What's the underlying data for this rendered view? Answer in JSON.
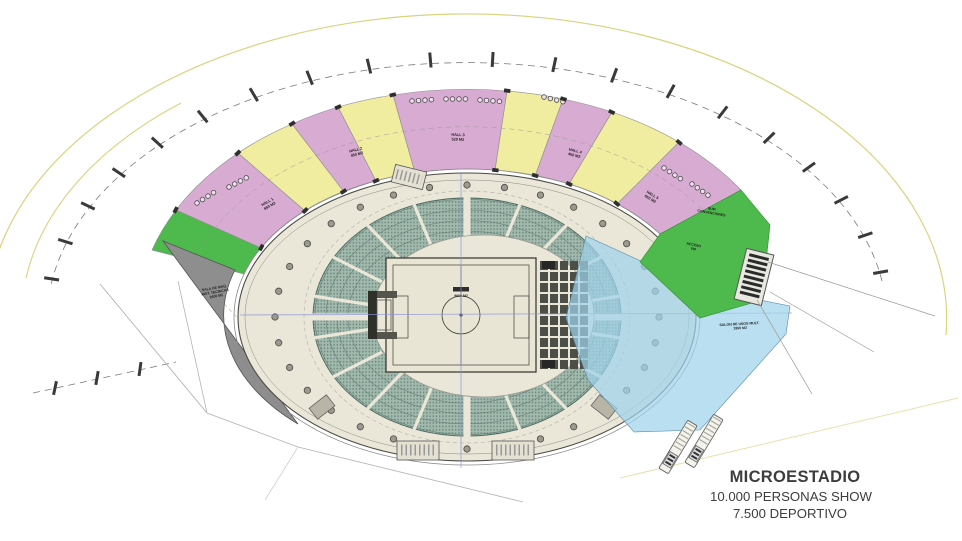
{
  "title_block": {
    "title": "MICROESTADIO",
    "line2": "10.000 PERSONAS SHOW",
    "line3": "7.500 DEPORTIVO"
  },
  "zones": {
    "hall_1": {
      "name": "HALL 1",
      "area": "650 M2"
    },
    "hall_2": {
      "name": "HALL 2",
      "area": "450 M2"
    },
    "hall_3": {
      "name": "HALL 3",
      "area": "520 M2"
    },
    "hall_4": {
      "name": "HALL 4",
      "area": "450 M2"
    },
    "hall_5": {
      "name": "HALL 5",
      "area": "650 M2"
    },
    "machine_room": {
      "line1": "SALA DE MAQ.",
      "line2": "INST. TECNICAS",
      "line3": "1600 M2"
    },
    "multipurpose": {
      "line1": "SALON DE USOS MULT.",
      "line2": "1950 M2"
    },
    "convention": {
      "line1": "SUM",
      "line2": "CONVENCIONES"
    },
    "vip_access": {
      "line1": "ACCESO",
      "line2": "VIP"
    },
    "field": {
      "area": "9600 M2"
    }
  },
  "colors": {
    "pink": "#d8abd2",
    "yellow": "#f0eda0",
    "green": "#4eb94c",
    "blue": "#9fd2ec",
    "gray-zone": "#8e8e8e",
    "concourse": "#eae6d8",
    "seats": "#a2b9ae",
    "site-line": "#d9d37e",
    "cad-line": "#8a93d6",
    "text": "#3d3d3d"
  }
}
